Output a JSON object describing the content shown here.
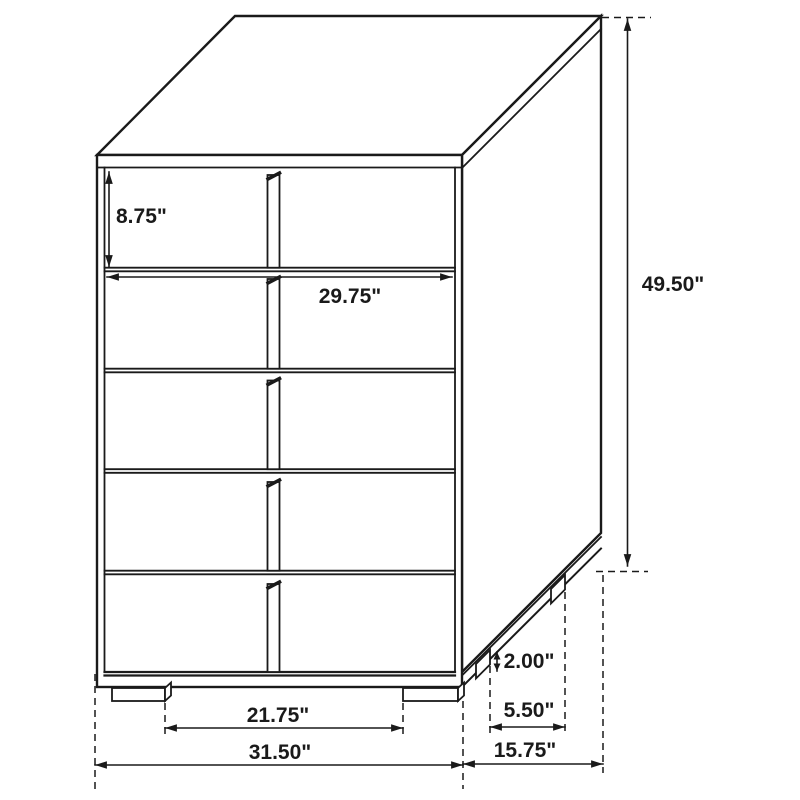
{
  "diagram": {
    "kind": "furniture-dimension-drawing",
    "subject": "five-drawer chest, three-quarter line view",
    "units": "inches",
    "line_color": "#1a1a1a",
    "background_color": "#ffffff"
  },
  "dimensions": {
    "top_drawer_height": "8.75\"",
    "drawer_width": "29.75\"",
    "overall_height": "49.50\"",
    "foot_height": "2.00\"",
    "foot_depth": "5.50\"",
    "front_feet_spacing": "21.75\"",
    "overall_width": "31.50\"",
    "overall_depth": "15.75\""
  }
}
